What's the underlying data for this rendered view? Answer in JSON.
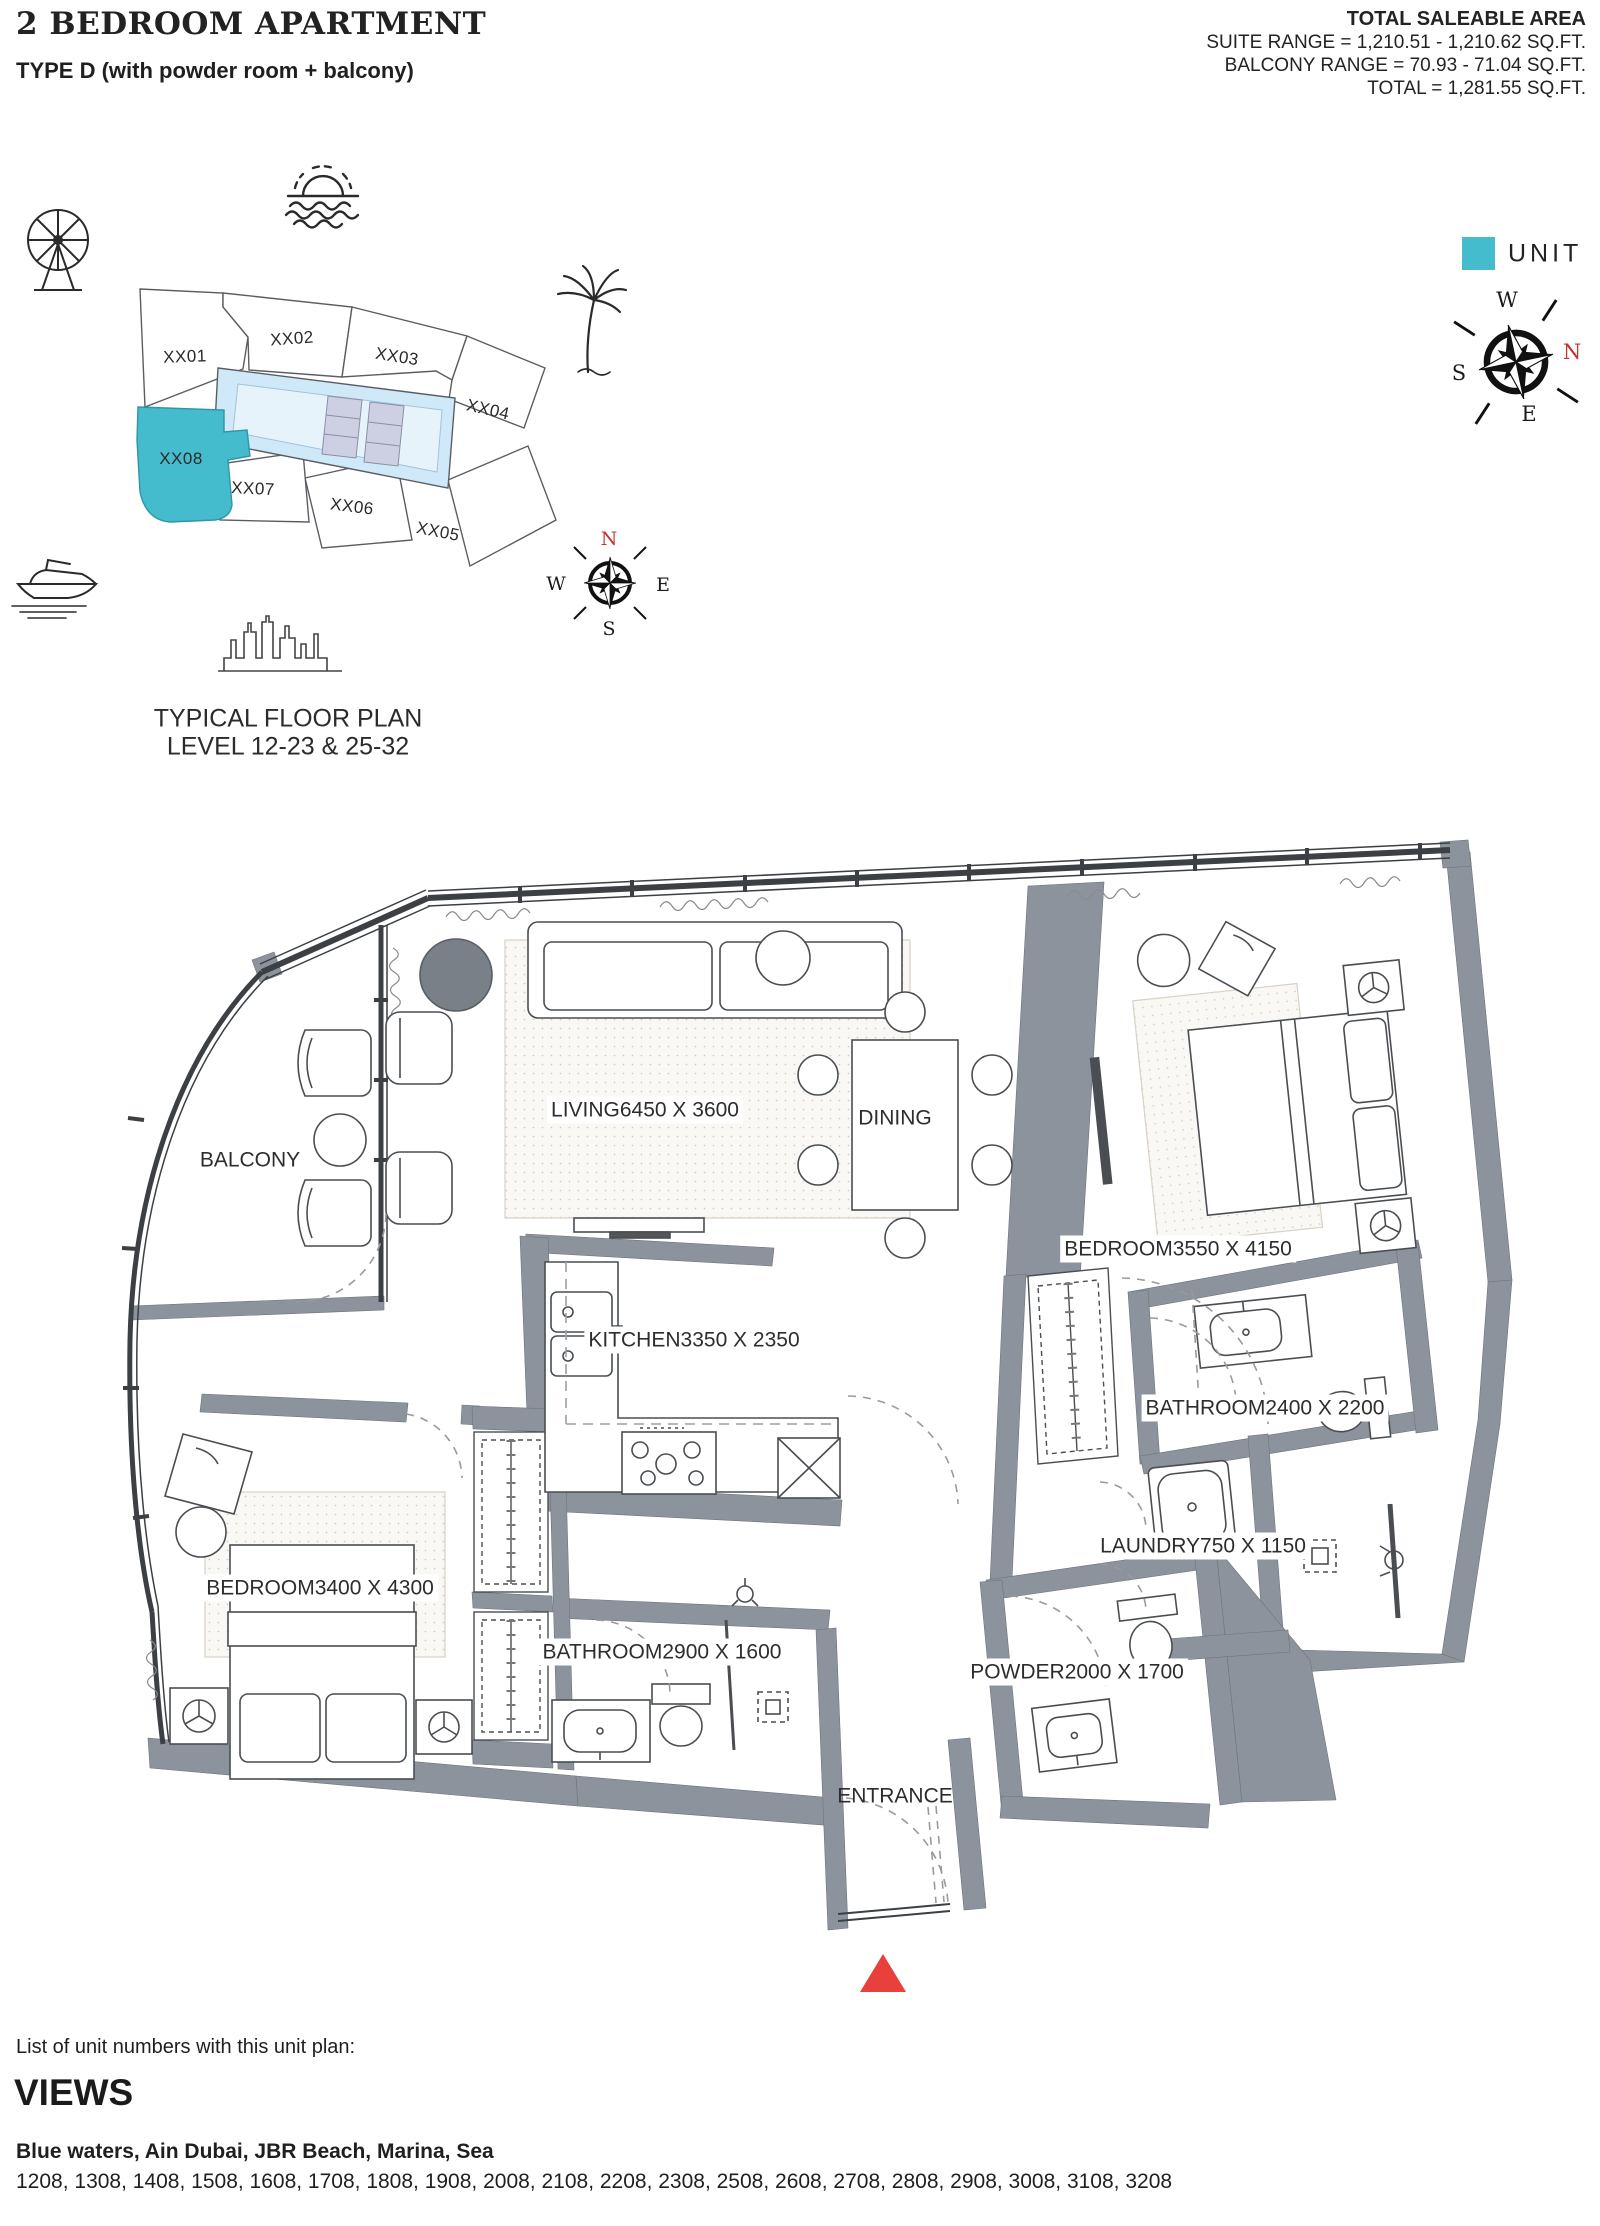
{
  "header": {
    "title": "2 BEDROOM APARTMENT",
    "subtitle": "TYPE D (with powder room + balcony)",
    "area_title": "TOTAL SALEABLE AREA",
    "area_line1": "SUITE RANGE = 1,210.51 - 1,210.62 SQ.FT.",
    "area_line2": "BALCONY RANGE = 70.93 - 71.04 SQ.FT.",
    "area_line3": "TOTAL = 1,281.55 SQ.FT."
  },
  "key_plan": {
    "units": [
      "XX01",
      "XX02",
      "XX03",
      "XX04",
      "XX05",
      "XX06",
      "XX07",
      "XX08"
    ],
    "highlighted_unit": "XX08",
    "highlight_color": "#45bccd",
    "core_color": "#cfe9f8",
    "caption_line1": "TYPICAL FLOOR PLAN",
    "caption_line2": "LEVEL 12-23 & 25-32",
    "legend_label": "UNIT"
  },
  "compass": {
    "north_color": "#c6332e",
    "small": {
      "n": "N",
      "e": "E",
      "s": "S",
      "w": "W"
    },
    "large": {
      "n": "N",
      "e": "E",
      "s": "S",
      "w": "W"
    }
  },
  "floor_plan": {
    "rooms": [
      {
        "name": "LIVING",
        "dims": "6450 X 3600"
      },
      {
        "name": "DINING",
        "dims": ""
      },
      {
        "name": "BEDROOM",
        "dims": "3550 X 4150"
      },
      {
        "name": "KITCHEN",
        "dims": "3350 X 2350"
      },
      {
        "name": "BATHROOM",
        "dims": "2400 X 2200"
      },
      {
        "name": "LAUNDRY",
        "dims": "750 X 1150"
      },
      {
        "name": "BEDROOM",
        "dims": "3400 X 4300"
      },
      {
        "name": "BATHROOM",
        "dims": "2900 X 1600"
      },
      {
        "name": "POWDER",
        "dims": "2000 X 1700"
      },
      {
        "name": "BALCONY",
        "dims": ""
      },
      {
        "name": "ENTRANCE",
        "dims": ""
      }
    ],
    "entrance_marker_color": "#e8403a",
    "wall_color": "#8d939c"
  },
  "footer": {
    "list_label": "List of unit numbers with this unit plan:",
    "views_title": "VIEWS",
    "views_value": "Blue waters, Ain Dubai, JBR Beach, Marina, Sea",
    "unit_numbers": "1208, 1308, 1408, 1508, 1608, 1708, 1808, 1908, 2008, 2108, 2208, 2308, 2508, 2608, 2708, 2808, 2908, 3008, 3108, 3208"
  }
}
